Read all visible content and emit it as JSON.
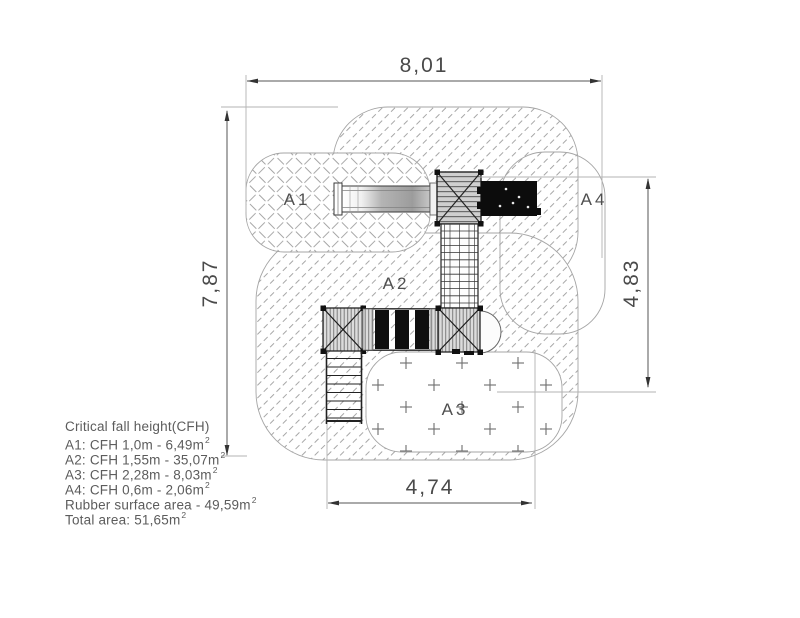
{
  "drawing": {
    "dimensions": {
      "top": "8,01",
      "left": "7,87",
      "right": "4,83",
      "bottom": "4,74"
    },
    "area_labels": {
      "a1": "A1",
      "a2": "A2",
      "a3": "A3",
      "a4": "A4"
    }
  },
  "legend": {
    "title": "Critical fall height(CFH)",
    "items": [
      {
        "text": "A1: CFH 1,0m - 6,49m",
        "sup": "2"
      },
      {
        "text": "A2: CFH 1,55m - 35,07m",
        "sup": "2"
      },
      {
        "text": "A3: CFH 2,28m - 8,03m",
        "sup": "2"
      },
      {
        "text": "A4: CFH 0,6m - 2,06m",
        "sup": "2"
      },
      {
        "text": "Rubber surface area - 49,59m",
        "sup": "2"
      },
      {
        "text": "Total area: 51,65m",
        "sup": "2"
      }
    ]
  },
  "colors": {
    "dimension_line": "#555555",
    "extension_line": "#b3b3b3",
    "hatch": "#8a8a8a",
    "outline": "#a5a5a5",
    "equipment_dark": "#0c0c0c",
    "text": "#4f4f4f"
  }
}
